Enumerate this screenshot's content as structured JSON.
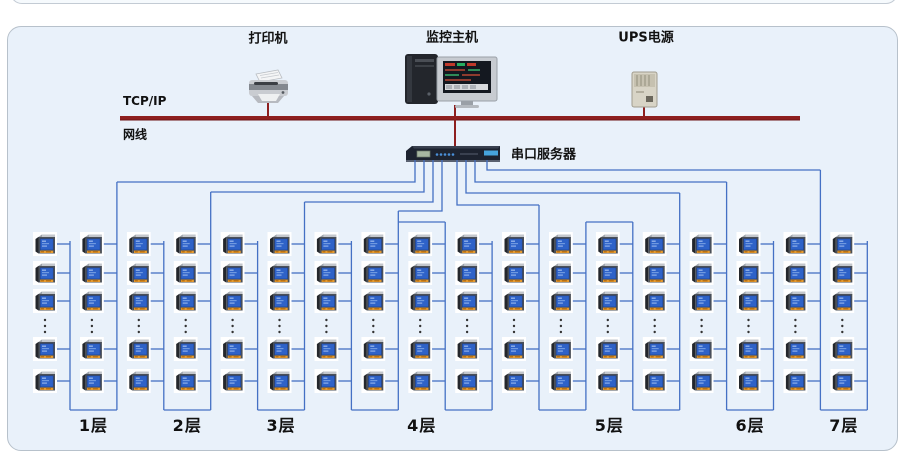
{
  "diagram_title": "power-monitoring-network-topology",
  "labels": {
    "printer": "打印机",
    "host": "监控主机",
    "ups": "UPS电源",
    "tcpip": "TCP/IP",
    "netcable": "网线",
    "serial_server": "串口服务器"
  },
  "backbone": {
    "protocol": "TCP/IP",
    "medium": "网线",
    "color": "#8e1f1f"
  },
  "serial_server": {
    "label": "串口服务器",
    "led_count": 5
  },
  "floors": [
    {
      "label": "1层",
      "columns": 2
    },
    {
      "label": "2层",
      "columns": 2
    },
    {
      "label": "3层",
      "columns": 2
    },
    {
      "label": "4层",
      "columns": 4
    },
    {
      "label": "5层",
      "columns": 4
    },
    {
      "label": "6层",
      "columns": 2
    },
    {
      "label": "7层",
      "columns": 2
    }
  ],
  "meters": {
    "visible_rows_per_column": 5,
    "ellipsis": "⋮",
    "total_columns": 18,
    "icon": "power-meter-icon"
  },
  "colors": {
    "panel_bg": "#e9f1fa",
    "panel_border": "#b7c1cb",
    "bus_line": "#4470c4",
    "backbone_red": "#8e1f1f",
    "meter_screen": "#2e62c8",
    "meter_label_strip": "#e79b2f",
    "server_body": "#1d2330",
    "server_led": "#4a90d9",
    "server_tag": "#46a4dc"
  }
}
